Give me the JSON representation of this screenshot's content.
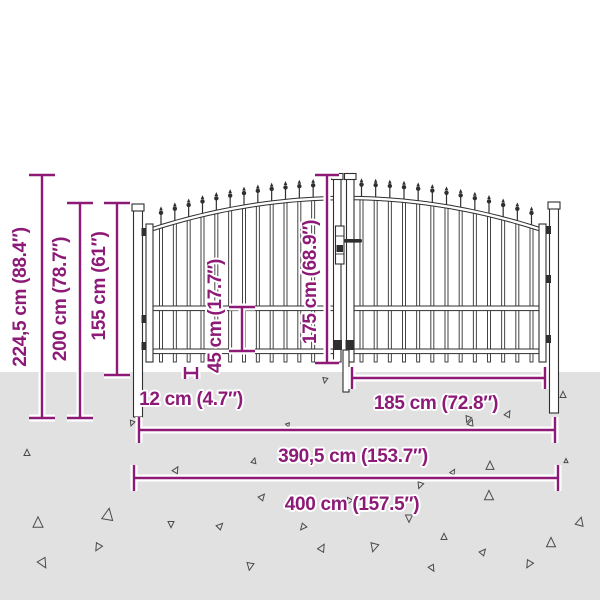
{
  "dimensions": {
    "total_height": "224,5 cm (88.4″)",
    "post_height": "200 cm (78.7″)",
    "fence_height": "155 cm (61″)",
    "lower_section_height": "45 cm (17.7″)",
    "door_height": "175 cm (68.9″)",
    "bar_spacing": "12 cm (4.7″)",
    "door_width": "185 cm (72.8″)",
    "inner_width": "390,5 cm (153.7″)",
    "total_width": "400 cm (157.5″)"
  },
  "colors": {
    "accent": "#8c1a76",
    "ground": "#e2e1e1",
    "line_art": "#2f2f2f",
    "background": "#ffffff"
  }
}
